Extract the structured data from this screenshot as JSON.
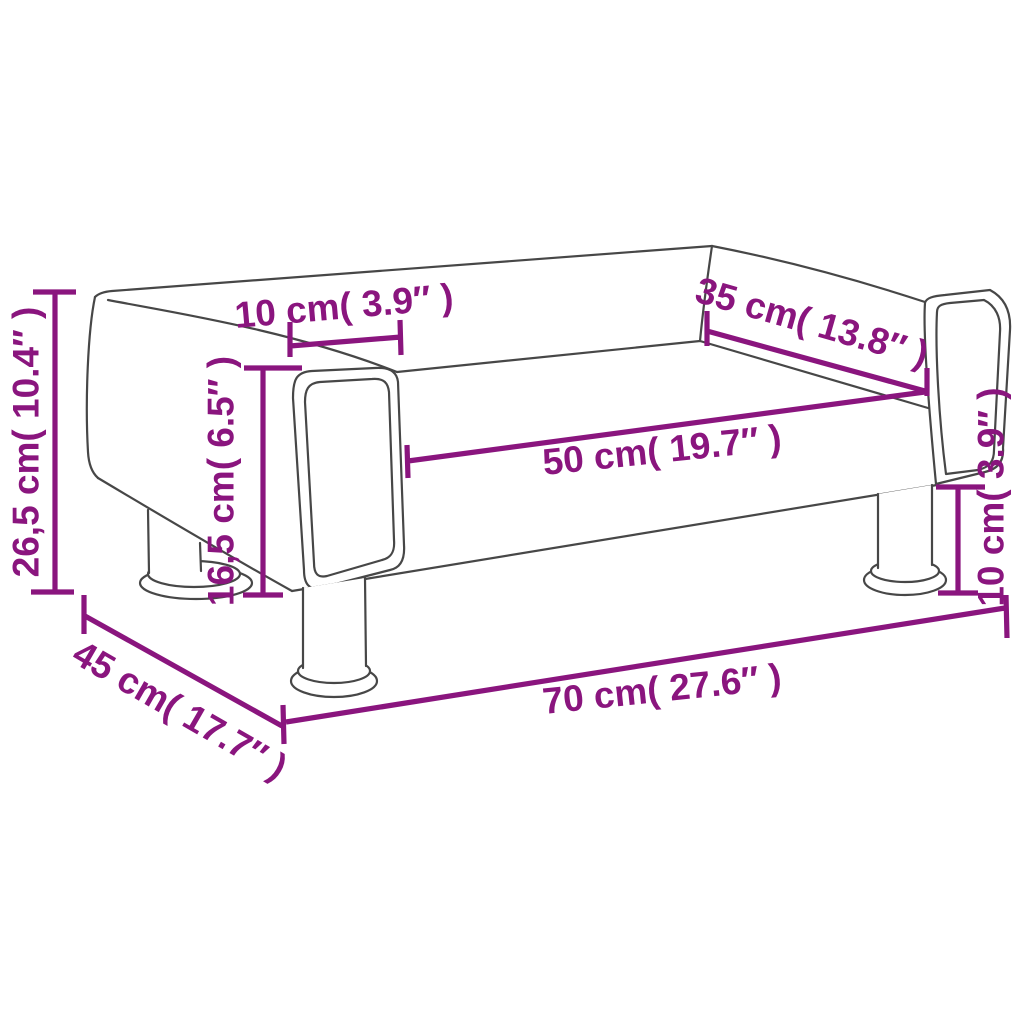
{
  "diagram": {
    "description": "Kids sofa dimensional line drawing",
    "colors": {
      "dimension": "#8A157E",
      "outline": "#474747",
      "background": "#ffffff"
    },
    "dimensions": [
      {
        "id": "total-height",
        "cm": "26,5",
        "inches": "10.4",
        "label": "26,5 cm( 10.4″ )"
      },
      {
        "id": "armrest-width",
        "cm": "10",
        "inches": "3.9",
        "label": "10 cm( 3.9″ )"
      },
      {
        "id": "seat-depth",
        "cm": "35",
        "inches": "13.8",
        "label": "35 cm( 13.8″ )"
      },
      {
        "id": "seat-width",
        "cm": "50",
        "inches": "19.7",
        "label": "50 cm( 19.7″ )"
      },
      {
        "id": "seat-height",
        "cm": "16,5",
        "inches": "6.5",
        "label": "16,5 cm( 6.5″ )"
      },
      {
        "id": "leg-height",
        "cm": "10",
        "inches": "3.9",
        "label": "10 cm( 3.9″ )"
      },
      {
        "id": "total-width",
        "cm": "70",
        "inches": "27.6",
        "label": "70 cm( 27.6″ )"
      },
      {
        "id": "total-depth",
        "cm": "45",
        "inches": "17.7",
        "label": "45 cm( 17.7″ )"
      }
    ]
  }
}
